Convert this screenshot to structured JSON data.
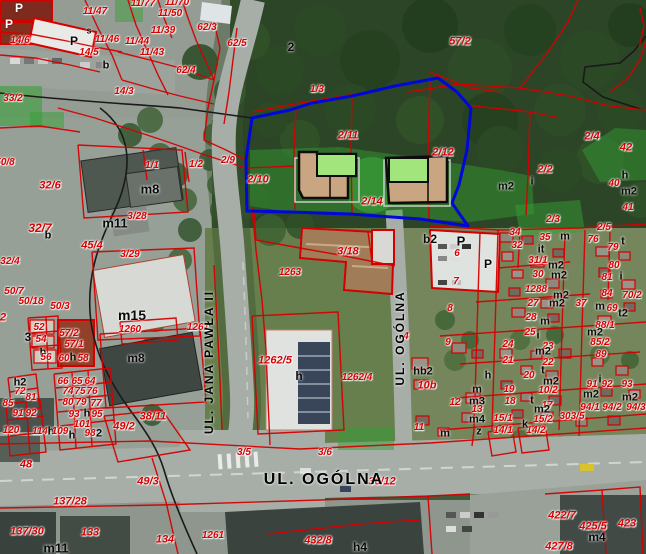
{
  "map": {
    "colors": {
      "parcel_line": "#d40000",
      "label_red": "#d60000",
      "boundary_black": "#1a1a1a",
      "site_outline": "#0008d8",
      "roof_green": "#a3e57d",
      "building_tan": "#c9a581",
      "veg_overlay": "#33a033",
      "road_gray": "#a7aea8"
    },
    "streets": {
      "jana_pawla": "UL. JANA PAWŁA II",
      "ogolna": "UL. OGÓLNA"
    },
    "labels": [
      [
        "P",
        19,
        8,
        "w",
        12
      ],
      [
        "P",
        9,
        24,
        "w",
        12
      ],
      [
        "s",
        89,
        31,
        "k",
        9
      ],
      [
        "P",
        74,
        41,
        "k",
        12
      ],
      [
        "b",
        106,
        66,
        "k",
        11
      ],
      [
        "11/47",
        95,
        12,
        "r"
      ],
      [
        "11/77",
        143,
        4,
        "r"
      ],
      [
        "11/70",
        177,
        3,
        "r"
      ],
      [
        "11/50",
        170,
        14,
        "r"
      ],
      [
        "11/39",
        163,
        31,
        "r"
      ],
      [
        "14/6",
        20,
        41,
        "r"
      ],
      [
        "11/46",
        107,
        40,
        "r"
      ],
      [
        "11/44",
        137,
        42,
        "r"
      ],
      [
        "14/5",
        89,
        53,
        "r"
      ],
      [
        "11/43",
        152,
        53,
        "r"
      ],
      [
        "62/3",
        207,
        28,
        "r"
      ],
      [
        "62/4",
        186,
        71,
        "r"
      ],
      [
        "62/5",
        237,
        44,
        "r"
      ],
      [
        "14/3",
        124,
        92,
        "r"
      ],
      [
        "33/2",
        13,
        99,
        "r"
      ],
      [
        "2",
        291,
        47,
        "k",
        12
      ],
      [
        "57/2",
        460,
        42,
        "r",
        11
      ],
      [
        "1/3",
        317,
        90,
        "r"
      ],
      [
        "2/11",
        348,
        136,
        "r",
        11
      ],
      [
        "2/12",
        443,
        153,
        "r",
        11
      ],
      [
        "2/9",
        228,
        161,
        "r"
      ],
      [
        "2/10",
        258,
        180,
        "r",
        11
      ],
      [
        "1/2",
        196,
        165,
        "r"
      ],
      [
        "1/1",
        152,
        166,
        "r"
      ],
      [
        "2/14",
        372,
        202,
        "r",
        11
      ],
      [
        "m8",
        150,
        189,
        "k",
        13
      ],
      [
        "32/6",
        50,
        186,
        "r",
        11
      ],
      [
        "m11",
        115,
        223,
        "k",
        13
      ],
      [
        "3/28",
        137,
        217,
        "r"
      ],
      [
        "32/7",
        40,
        228,
        "r",
        12
      ],
      [
        "b",
        48,
        236,
        "k",
        11
      ],
      [
        "45/4",
        92,
        246,
        "r",
        11
      ],
      [
        "50/8",
        5,
        163,
        "r"
      ],
      [
        "32/4",
        10,
        262,
        "r"
      ],
      [
        "3/29",
        130,
        255,
        "r"
      ],
      [
        "50/7",
        14,
        292,
        "r"
      ],
      [
        "50/18",
        31,
        302,
        "r"
      ],
      [
        "50/3",
        60,
        307,
        "r"
      ],
      [
        "m15",
        132,
        315,
        "k",
        14
      ],
      [
        "1260",
        130,
        330,
        "r"
      ],
      [
        "2",
        3,
        318,
        "r",
        11
      ],
      [
        "52",
        39,
        328,
        "r"
      ],
      [
        "3",
        28,
        337,
        "k",
        12
      ],
      [
        "54",
        41,
        340,
        "r"
      ],
      [
        "57/2",
        69,
        334,
        "r"
      ],
      [
        "57/1",
        74,
        345,
        "r"
      ],
      [
        "h",
        43,
        353,
        "k"
      ],
      [
        "56",
        46,
        358,
        "r"
      ],
      [
        "60",
        64,
        359,
        "r"
      ],
      [
        "h",
        73,
        358,
        "k"
      ],
      [
        "58",
        83,
        359,
        "r"
      ],
      [
        "m8",
        136,
        358,
        "k",
        12
      ],
      [
        "1261",
        198,
        328,
        "r"
      ],
      [
        "1263",
        290,
        273,
        "r"
      ],
      [
        "3/18",
        348,
        252,
        "r",
        11
      ],
      [
        "1262/5",
        275,
        361,
        "r",
        11
      ],
      [
        "1262/4",
        357,
        378,
        "r"
      ],
      [
        "h",
        299,
        376,
        "k",
        12
      ],
      [
        "h2",
        20,
        383,
        "k"
      ],
      [
        "72",
        20,
        392,
        "r"
      ],
      [
        "81",
        31,
        398,
        "r"
      ],
      [
        "85",
        8,
        404,
        "r"
      ],
      [
        "66",
        63,
        382,
        "r"
      ],
      [
        "65",
        77,
        382,
        "r"
      ],
      [
        "64",
        90,
        382,
        "r"
      ],
      [
        "74",
        68,
        392,
        "r"
      ],
      [
        "75",
        80,
        392,
        "r"
      ],
      [
        "76",
        92,
        392,
        "r"
      ],
      [
        "80",
        68,
        403,
        "r"
      ],
      [
        "79",
        81,
        403,
        "r"
      ],
      [
        "77",
        96,
        404,
        "r"
      ],
      [
        "91",
        18,
        414,
        "r"
      ],
      [
        "92",
        31,
        414,
        "r"
      ],
      [
        "93",
        74,
        415,
        "r"
      ],
      [
        "h",
        87,
        414,
        "k"
      ],
      [
        "95",
        97,
        415,
        "r"
      ],
      [
        "101",
        82,
        425,
        "r"
      ],
      [
        "120",
        11,
        431,
        "r"
      ],
      [
        "114",
        40,
        432,
        "r"
      ],
      [
        "h",
        51,
        432,
        "k"
      ],
      [
        "109",
        60,
        432,
        "r"
      ],
      [
        "h",
        72,
        436,
        "k"
      ],
      [
        "98",
        90,
        434,
        "r"
      ],
      [
        "2",
        99,
        434,
        "k"
      ],
      [
        "38/11",
        153,
        417,
        "r",
        11
      ],
      [
        "49/2",
        124,
        427,
        "r",
        11
      ],
      [
        "48",
        26,
        465,
        "r",
        11
      ],
      [
        "49/3",
        148,
        482,
        "r",
        11
      ],
      [
        "137/28",
        70,
        502,
        "r",
        11
      ],
      [
        "137/30",
        27,
        532,
        "r",
        11
      ],
      [
        "133",
        90,
        533,
        "r",
        11
      ],
      [
        "134",
        165,
        540,
        "r",
        11
      ],
      [
        "1261",
        213,
        536,
        "r"
      ],
      [
        "m11",
        56,
        548,
        "k",
        13
      ],
      [
        "3/5",
        244,
        453,
        "r"
      ],
      [
        "3/6",
        325,
        453,
        "r"
      ],
      [
        "36/12",
        382,
        482,
        "r",
        11
      ],
      [
        "432/8",
        318,
        541,
        "r",
        11
      ],
      [
        "h4",
        360,
        547,
        "k",
        12
      ],
      [
        "14/1",
        503,
        431,
        "r"
      ],
      [
        "14/2",
        536,
        431,
        "r"
      ],
      [
        "422/7",
        562,
        516,
        "r",
        11
      ],
      [
        "425/5",
        593,
        527,
        "r",
        11
      ],
      [
        "423",
        627,
        524,
        "r",
        11
      ],
      [
        "m4",
        597,
        537,
        "k",
        12
      ],
      [
        "427/8",
        559,
        547,
        "r",
        11
      ],
      [
        "b2",
        430,
        239,
        "k",
        12
      ],
      [
        "P",
        461,
        241,
        "k",
        13
      ],
      [
        "6",
        457,
        254,
        "r"
      ],
      [
        "P",
        488,
        264,
        "k",
        12
      ],
      [
        "7",
        456,
        282,
        "r"
      ],
      [
        "8",
        450,
        309,
        "r"
      ],
      [
        "2/3",
        553,
        220,
        "r"
      ],
      [
        "2/2",
        545,
        170,
        "r",
        11
      ],
      [
        "i",
        532,
        182,
        "k"
      ],
      [
        "m2",
        506,
        187,
        "k"
      ],
      [
        "2/4",
        592,
        137,
        "r",
        11
      ],
      [
        "42",
        626,
        148,
        "r",
        11
      ],
      [
        "40",
        614,
        184,
        "r"
      ],
      [
        "h",
        625,
        176,
        "k"
      ],
      [
        "m2",
        629,
        192,
        "k"
      ],
      [
        "41",
        628,
        208,
        "r"
      ],
      [
        "2/5",
        604,
        228,
        "r"
      ],
      [
        "34",
        515,
        233,
        "r"
      ],
      [
        "35",
        545,
        238,
        "r"
      ],
      [
        "32",
        517,
        246,
        "r"
      ],
      [
        "it",
        541,
        250,
        "k"
      ],
      [
        "m",
        565,
        237,
        "k"
      ],
      [
        "76",
        593,
        240,
        "r"
      ],
      [
        "31/1",
        538,
        261,
        "r"
      ],
      [
        "m2",
        556,
        266,
        "k"
      ],
      [
        "30",
        538,
        275,
        "r"
      ],
      [
        "m2",
        559,
        276,
        "k"
      ],
      [
        "1288",
        536,
        290,
        "r"
      ],
      [
        "m2",
        561,
        296,
        "k"
      ],
      [
        "27",
        533,
        304,
        "r"
      ],
      [
        "m2",
        557,
        304,
        "k"
      ],
      [
        "37",
        581,
        304,
        "r"
      ],
      [
        "28",
        531,
        318,
        "r"
      ],
      [
        "m",
        545,
        322,
        "k"
      ],
      [
        "t",
        623,
        242,
        "k"
      ],
      [
        "79",
        613,
        248,
        "r"
      ],
      [
        "80",
        614,
        266,
        "r"
      ],
      [
        "81",
        607,
        278,
        "r"
      ],
      [
        "i",
        621,
        277,
        "k"
      ],
      [
        "84",
        607,
        294,
        "r"
      ],
      [
        "70/2",
        632,
        296,
        "r"
      ],
      [
        "m",
        600,
        307,
        "k"
      ],
      [
        "69",
        612,
        309,
        "r"
      ],
      [
        "t2",
        623,
        314,
        "k"
      ],
      [
        "88/1",
        605,
        326,
        "r"
      ],
      [
        "hb2",
        423,
        372,
        "k"
      ],
      [
        "10b",
        427,
        386,
        "r",
        11
      ],
      [
        "11",
        419,
        428,
        "r"
      ],
      [
        "4",
        406,
        337,
        "r"
      ],
      [
        "m",
        445,
        434,
        "k"
      ],
      [
        "9",
        448,
        343,
        "r"
      ],
      [
        "24",
        508,
        345,
        "r"
      ],
      [
        "25",
        530,
        333,
        "r"
      ],
      [
        "i",
        538,
        336,
        "k"
      ],
      [
        "23",
        548,
        347,
        "r"
      ],
      [
        "m2",
        543,
        352,
        "k"
      ],
      [
        "21",
        508,
        361,
        "r"
      ],
      [
        "22",
        548,
        363,
        "r"
      ],
      [
        "20",
        529,
        376,
        "r"
      ],
      [
        "t",
        543,
        371,
        "k"
      ],
      [
        "m2",
        551,
        382,
        "k"
      ],
      [
        "10/2",
        548,
        391,
        "r"
      ],
      [
        "19",
        509,
        390,
        "r"
      ],
      [
        "18",
        510,
        402,
        "r"
      ],
      [
        "t",
        532,
        401,
        "k"
      ],
      [
        "17",
        547,
        406,
        "r"
      ],
      [
        "m2",
        542,
        410,
        "k"
      ],
      [
        "15/1",
        503,
        419,
        "r"
      ],
      [
        "15/2",
        543,
        420,
        "r"
      ],
      [
        "k",
        525,
        425,
        "k"
      ],
      [
        "303/5",
        572,
        417,
        "r"
      ],
      [
        "h",
        488,
        376,
        "k"
      ],
      [
        "12",
        455,
        403,
        "r"
      ],
      [
        "m",
        477,
        390,
        "k"
      ],
      [
        "m3",
        477,
        402,
        "k"
      ],
      [
        "13",
        477,
        410,
        "r"
      ],
      [
        "m4",
        477,
        420,
        "k"
      ],
      [
        "z",
        479,
        432,
        "k"
      ],
      [
        "85/2",
        600,
        343,
        "r"
      ],
      [
        "89",
        601,
        355,
        "r"
      ],
      [
        "91",
        592,
        385,
        "r"
      ],
      [
        "92",
        607,
        385,
        "r"
      ],
      [
        "i",
        600,
        380,
        "k"
      ],
      [
        "m2",
        591,
        395,
        "k"
      ],
      [
        "93",
        627,
        385,
        "r"
      ],
      [
        "m2",
        630,
        398,
        "k"
      ],
      [
        "94/1",
        590,
        408,
        "r"
      ],
      [
        "94/2",
        612,
        408,
        "r"
      ],
      [
        "94/3",
        636,
        408,
        "r"
      ],
      [
        "m2",
        595,
        333,
        "k"
      ],
      [
        "UL. JANA PAWŁA II",
        209,
        362,
        "s",
        12,
        -90
      ],
      [
        "UL. OGÓLNA",
        400,
        338,
        "s",
        12,
        -90
      ],
      [
        "UL. OGÓLNA",
        324,
        480,
        "s",
        16,
        0
      ]
    ]
  }
}
